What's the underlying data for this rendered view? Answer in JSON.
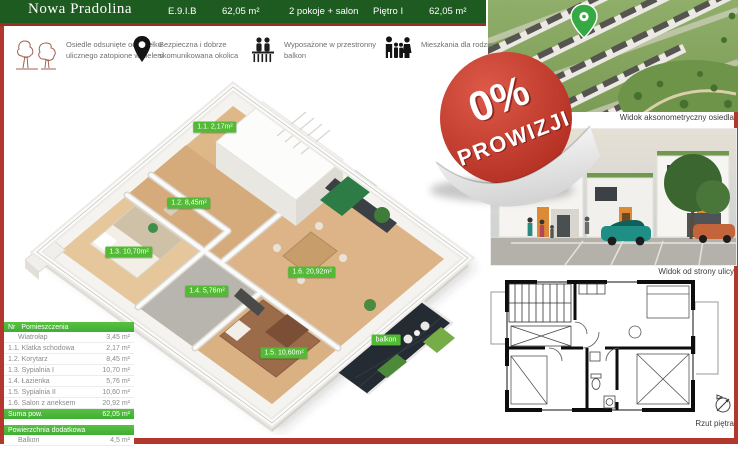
{
  "header": {
    "title": "Nowa Pradolina",
    "unit": "E.9.I.B",
    "area_1": "62,05 m²",
    "layout": "2 pokoje + salon",
    "floor": "Piętro I",
    "area_2": "62,05 m²"
  },
  "features": [
    {
      "icon": "trees-icon",
      "text": "Osiedle odsunięte od zgiełku ulicznego zatopione w zieleni"
    },
    {
      "icon": "location-pin-icon",
      "text": "Bezpieczna i dobrze skomunikowana okolica"
    },
    {
      "icon": "balcony-icon",
      "text": "Wyposażone w przestronny balkon"
    },
    {
      "icon": "family-icon",
      "text": "Mieszkania dla rodzin"
    }
  ],
  "badge": {
    "percent": "0%",
    "word": "PROWIZJI"
  },
  "plan_labels": [
    {
      "text": "1.1. 2,17m²",
      "x": 215,
      "y": 127
    },
    {
      "text": "1.2. 8,45m²",
      "x": 189,
      "y": 203
    },
    {
      "text": "1.3. 10,70m²",
      "x": 129,
      "y": 252
    },
    {
      "text": "1.4. 5,76m²",
      "x": 207,
      "y": 291
    },
    {
      "text": "1.6. 20,92m²",
      "x": 312,
      "y": 272
    },
    {
      "text": "1.5. 10,60m²",
      "x": 284,
      "y": 353
    },
    {
      "text": "balkon",
      "x": 386,
      "y": 340
    }
  ],
  "rooms_table": {
    "header": {
      "nr": "Nr",
      "name": "Pomieszczenia"
    },
    "rows": [
      {
        "nr": "",
        "name": "Wiatrołap",
        "area": "3,45 m²"
      },
      {
        "nr": "1.1.",
        "name": "Klatka schodowa",
        "area": "2,17 m²"
      },
      {
        "nr": "1.2.",
        "name": "Korytarz",
        "area": "8,45 m²"
      },
      {
        "nr": "1.3.",
        "name": "Sypialnia I",
        "area": "10,70 m²"
      },
      {
        "nr": "1.4.",
        "name": "Łazienka",
        "area": "5,76 m²"
      },
      {
        "nr": "1.5.",
        "name": "Sypialnia II",
        "area": "10,60 m²"
      },
      {
        "nr": "1.6.",
        "name": "Salon z aneksem",
        "area": "20,92 m²"
      }
    ],
    "total": {
      "label": "Suma pow.",
      "value": "62,05 m²"
    },
    "extra_header": "Powierzchnia dodatkowa",
    "extra_rows": [
      {
        "name": "Balkon",
        "area": "4,5 m²"
      }
    ]
  },
  "captions": {
    "aerial": "Widok aksonometryczny osiedla",
    "street": "Widok od strony ulicy",
    "plan": "Rzut piętra"
  },
  "colors": {
    "header_green": "#1e5b20",
    "frame_red": "#b2372d",
    "table_green": "#4bb53c",
    "label_green": "#53ba36",
    "badge_red": "#c0392b"
  }
}
